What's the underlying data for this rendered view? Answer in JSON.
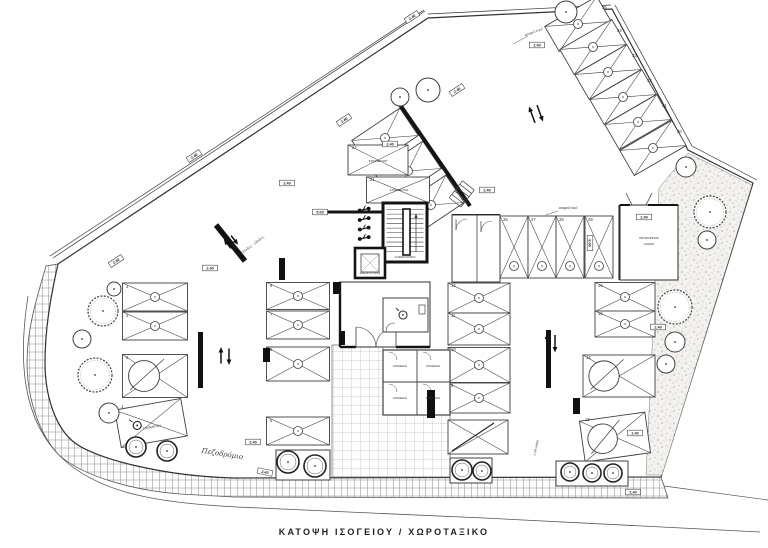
{
  "meta": {
    "caption": "ΚΑΤΟΨΗ ΙΣΟΓΕΙΟΥ / ΧΩΡΟΤΑΞΙΚΟ"
  },
  "colors": {
    "line": "#3f3f3f",
    "wall": "#141414",
    "text": "#2b2b2b"
  },
  "stalls": [
    {
      "n": "35",
      "x": 578,
      "y": 24,
      "l": 60,
      "w": 29,
      "r": -30,
      "sym": "circle",
      "nd": [
        24,
        -15
      ]
    },
    {
      "n": "34",
      "x": 593,
      "y": 47,
      "l": 60,
      "w": 29,
      "r": -30,
      "sym": "circle",
      "nd": [
        24,
        -15
      ]
    },
    {
      "n": "33",
      "x": 608,
      "y": 72,
      "l": 60,
      "w": 29,
      "r": -30,
      "sym": "circle",
      "nd": [
        24,
        -15
      ]
    },
    {
      "n": "32",
      "x": 623,
      "y": 97,
      "l": 60,
      "w": 29,
      "r": -30,
      "sym": "circle",
      "nd": [
        24,
        -15
      ]
    },
    {
      "n": "31",
      "x": 638,
      "y": 122,
      "l": 60,
      "w": 29,
      "r": -30,
      "sym": "circle",
      "nd": [
        24,
        -15
      ]
    },
    {
      "n": "30",
      "x": 653,
      "y": 148,
      "l": 60,
      "w": 29,
      "r": -30,
      "sym": "circle",
      "nd": [
        24,
        -15
      ]
    },
    {
      "n": "23",
      "x": 385,
      "y": 138,
      "l": 58,
      "w": 33,
      "r": -34,
      "sym": "circle",
      "nd": [
        31,
        -5
      ]
    },
    {
      "n": "24",
      "x": 408,
      "y": 171,
      "l": 58,
      "w": 33,
      "r": -34,
      "sym": "circle",
      "nd": [
        31,
        -5
      ]
    },
    {
      "n": "25",
      "x": 431,
      "y": 205,
      "l": 58,
      "w": 33,
      "r": -34,
      "sym": "circle",
      "nd": [
        31,
        -5
      ]
    },
    {
      "n": "22",
      "x": 378,
      "y": 160,
      "l": 60,
      "w": 30,
      "r": 0,
      "sym": "none",
      "nd": [
        -26,
        -11
      ]
    },
    {
      "n": "21",
      "x": 398,
      "y": 190,
      "l": 63,
      "w": 26,
      "r": 0,
      "sym": "none",
      "nd": [
        -28,
        -9
      ]
    },
    {
      "n": "26",
      "x": 514,
      "y": 247,
      "l": 62,
      "w": 28,
      "r": 90,
      "sym": "circle-out",
      "nd": [
        -11,
        -26
      ]
    },
    {
      "n": "27",
      "x": 542,
      "y": 247,
      "l": 62,
      "w": 28,
      "r": 90,
      "sym": "circle-out",
      "nd": [
        -11,
        -26
      ]
    },
    {
      "n": "28",
      "x": 570,
      "y": 247,
      "l": 62,
      "w": 28,
      "r": 90,
      "sym": "circle-out",
      "nd": [
        -11,
        -26
      ]
    },
    {
      "n": "29",
      "x": 599,
      "y": 247,
      "l": 62,
      "w": 28,
      "r": 90,
      "sym": "circle-out",
      "nd": [
        -11,
        -26
      ]
    },
    {
      "n": "4",
      "x": 155,
      "y": 297,
      "l": 65,
      "w": 28,
      "r": 0,
      "sym": "circle",
      "nd": [
        -29,
        -9
      ]
    },
    {
      "n": "3",
      "x": 155,
      "y": 326,
      "l": 65,
      "w": 28,
      "r": 0,
      "sym": "circle",
      "nd": [
        -29,
        -9
      ]
    },
    {
      "n": "2",
      "x": 155,
      "y": 376,
      "l": 65,
      "w": 43,
      "r": 0,
      "sym": "bigcircle",
      "nd": [
        -29,
        -17
      ]
    },
    {
      "n": "1",
      "x": 151,
      "y": 423,
      "l": 67,
      "w": 38,
      "r": -10,
      "sym": "wheel",
      "nd": [
        -30,
        -15
      ]
    },
    {
      "n": "8",
      "x": 298,
      "y": 296,
      "l": 63,
      "w": 27,
      "r": 0,
      "sym": "circle",
      "nd": [
        -28,
        -9
      ]
    },
    {
      "n": "7",
      "x": 298,
      "y": 325,
      "l": 63,
      "w": 28,
      "r": 0,
      "sym": "circle",
      "nd": [
        -28,
        -9
      ]
    },
    {
      "n": "6",
      "x": 298,
      "y": 364,
      "l": 63,
      "w": 34,
      "r": 0,
      "sym": "circle",
      "nd": [
        -28,
        -13
      ]
    },
    {
      "n": "5",
      "x": 298,
      "y": 431,
      "l": 63,
      "w": 28,
      "r": 0,
      "sym": "circle",
      "nd": [
        -28,
        -9
      ]
    },
    {
      "n": "12",
      "x": 479,
      "y": 298,
      "l": 62,
      "w": 30,
      "r": 0,
      "sym": "circle",
      "nd": [
        -28,
        -11
      ]
    },
    {
      "n": "11",
      "x": 479,
      "y": 329,
      "l": 62,
      "w": 32,
      "r": 0,
      "sym": "circle",
      "nd": [
        -28,
        -12
      ]
    },
    {
      "n": "10",
      "x": 479,
      "y": 365,
      "l": 62,
      "w": 35,
      "r": 0,
      "sym": "circle",
      "nd": [
        -28,
        -14
      ]
    },
    {
      "n": "9",
      "x": 479,
      "y": 398,
      "l": 62,
      "w": 30,
      "r": 0,
      "sym": "circle",
      "nd": [
        -28,
        -11
      ]
    },
    {
      "n": "",
      "x": 478,
      "y": 437,
      "l": 60,
      "w": 34,
      "r": 0,
      "sym": "slash",
      "nd": [
        0,
        0
      ]
    },
    {
      "n": "16",
      "x": 625,
      "y": 297,
      "l": 60,
      "w": 29,
      "r": 0,
      "sym": "circle",
      "nd": [
        -27,
        -10
      ]
    },
    {
      "n": "15",
      "x": 625,
      "y": 324,
      "l": 60,
      "w": 26,
      "r": 0,
      "sym": "circle",
      "nd": [
        -27,
        -9
      ]
    },
    {
      "n": "14",
      "x": 619,
      "y": 376,
      "l": 72,
      "w": 42,
      "r": 0,
      "sym": "bigcircle",
      "nd": [
        -33,
        -17
      ]
    },
    {
      "n": "13",
      "x": 615,
      "y": 437,
      "l": 66,
      "w": 41,
      "r": -8,
      "sym": "bigcircle",
      "nd": [
        -30,
        -16
      ]
    }
  ],
  "trees": [
    {
      "x": 103,
      "y": 311,
      "rr": 15,
      "t": "bushy"
    },
    {
      "x": 82,
      "y": 339,
      "rr": 9,
      "t": "plain"
    },
    {
      "x": 95,
      "y": 375,
      "rr": 17,
      "t": "bushy"
    },
    {
      "x": 109,
      "y": 413,
      "rr": 10,
      "t": "plain"
    },
    {
      "x": 114,
      "y": 289,
      "rr": 7,
      "t": "plain"
    },
    {
      "x": 136,
      "y": 447,
      "rr": 10,
      "t": "grate"
    },
    {
      "x": 167,
      "y": 451,
      "rr": 10,
      "t": "grate"
    },
    {
      "x": 288,
      "y": 462,
      "rr": 11,
      "t": "grate"
    },
    {
      "x": 315,
      "y": 466,
      "rr": 11,
      "t": "grate"
    },
    {
      "x": 400,
      "y": 97,
      "rr": 9,
      "t": "plain"
    },
    {
      "x": 428,
      "y": 90,
      "rr": 12,
      "t": "plain"
    },
    {
      "x": 566,
      "y": 12,
      "rr": 11,
      "t": "plain"
    },
    {
      "x": 686,
      "y": 167,
      "rr": 10,
      "t": "plain"
    },
    {
      "x": 710,
      "y": 212,
      "rr": 16,
      "t": "bushy"
    },
    {
      "x": 707,
      "y": 240,
      "rr": 9,
      "t": "plain"
    },
    {
      "x": 675,
      "y": 307,
      "rr": 17,
      "t": "bushy"
    },
    {
      "x": 675,
      "y": 342,
      "rr": 10,
      "t": "plain"
    },
    {
      "x": 666,
      "y": 364,
      "rr": 9,
      "t": "plain"
    },
    {
      "x": 462,
      "y": 470,
      "rr": 10,
      "t": "grate"
    },
    {
      "x": 482,
      "y": 471,
      "rr": 9,
      "t": "grate"
    },
    {
      "x": 570,
      "y": 472,
      "rr": 9,
      "t": "grate"
    },
    {
      "x": 592,
      "y": 473,
      "rr": 9,
      "t": "grate"
    },
    {
      "x": 613,
      "y": 473,
      "rr": 9,
      "t": "grate"
    }
  ],
  "planter_boxes": [
    {
      "x": 450,
      "y": 458,
      "w": 42,
      "h": 25
    },
    {
      "x": 556,
      "y": 461,
      "w": 72,
      "h": 25
    },
    {
      "x": 276,
      "y": 450,
      "w": 54,
      "h": 30
    }
  ],
  "arrows": [
    {
      "x": 536,
      "y": 114,
      "r": -20,
      "len": 16
    },
    {
      "x": 225,
      "y": 356,
      "r": 0,
      "len": 15
    },
    {
      "x": 551,
      "y": 343,
      "r": 0,
      "len": 16
    },
    {
      "x": 231,
      "y": 242,
      "r": -38,
      "len": 10
    }
  ],
  "dim_tags": [
    {
      "x": 344,
      "y": 120,
      "r": -33,
      "t": "2.40"
    },
    {
      "x": 116,
      "y": 261,
      "r": -33,
      "t": "2.40"
    },
    {
      "x": 412,
      "y": 17,
      "r": -33,
      "t": "2.40"
    },
    {
      "x": 194,
      "y": 156,
      "r": -33,
      "t": "2.40"
    },
    {
      "x": 537,
      "y": 45,
      "r": 0,
      "t": "2.40"
    },
    {
      "x": 287,
      "y": 183,
      "r": 0,
      "t": "2.40"
    },
    {
      "x": 390,
      "y": 144,
      "r": 0,
      "t": "2.40"
    },
    {
      "x": 487,
      "y": 190,
      "r": 0,
      "t": "2.40"
    },
    {
      "x": 644,
      "y": 217,
      "r": 0,
      "t": "2.40"
    },
    {
      "x": 590,
      "y": 243,
      "r": 90,
      "t": "6.00"
    },
    {
      "x": 658,
      "y": 327,
      "r": 0,
      "t": "2.40"
    },
    {
      "x": 635,
      "y": 433,
      "r": 0,
      "t": "2.40"
    },
    {
      "x": 265,
      "y": 472,
      "r": 12,
      "t": "2.40"
    },
    {
      "x": 253,
      "y": 442,
      "r": 0,
      "t": "2.40"
    },
    {
      "x": 457,
      "y": 90,
      "r": -33,
      "t": "2.40"
    },
    {
      "x": 320,
      "y": 212,
      "r": 0,
      "t": "5.00"
    },
    {
      "x": 210,
      "y": 268,
      "r": 0,
      "t": "2.40"
    },
    {
      "x": 633,
      "y": 492,
      "r": 0,
      "t": "2.40"
    }
  ],
  "notes": [
    {
      "x": 378,
      "y": 162,
      "r": 0,
      "s": 3.1,
      "st": "room",
      "t": "ΣΤΑΘΜΕΥΣΗ"
    },
    {
      "x": 399,
      "y": 191,
      "r": 0,
      "s": 3.0,
      "st": "room",
      "t": "ΣΤΑΘΜΕΥΣΗ"
    },
    {
      "x": 152,
      "y": 428,
      "r": -10,
      "s": 3.0,
      "st": "room",
      "t": "ΣΤΑΘΜΕΥΣΗ"
    },
    {
      "x": 400,
      "y": 367,
      "r": 0,
      "s": 2.8,
      "st": "room",
      "t": "ΑΠΟΘΗΚΗ"
    },
    {
      "x": 433,
      "y": 367,
      "r": 0,
      "s": 2.8,
      "st": "room",
      "t": "ΑΠΟΘΗΚΗ"
    },
    {
      "x": 400,
      "y": 399,
      "r": 0,
      "s": 2.8,
      "st": "room",
      "t": "ΑΠΟΘΗΚΗ"
    },
    {
      "x": 433,
      "y": 399,
      "r": 0,
      "s": 2.8,
      "st": "room",
      "t": "ΑΠΟΘΗΚΗ"
    },
    {
      "x": 649,
      "y": 239,
      "r": 0,
      "s": 3.0,
      "st": "room",
      "t": "ΠΡΟΣΩΡΙΝΟΣ"
    },
    {
      "x": 649,
      "y": 245,
      "r": 0,
      "s": 3.0,
      "st": "room",
      "t": "ΚΑΔΟΣ"
    },
    {
      "x": 405,
      "y": 258,
      "r": 0,
      "s": 2.6,
      "st": "room",
      "t": "ΚΛΙΜΑΚΟΣΤΑΣΙΟ"
    },
    {
      "x": 370,
      "y": 274,
      "r": 0,
      "s": 2.6,
      "st": "room",
      "t": "ΑΝΕΛΚΥΣΤΗΡΑΣ"
    },
    {
      "x": 537,
      "y": 448,
      "r": -78,
      "s": 3.2,
      "st": "room",
      "t": "± 2% κλίση"
    },
    {
      "x": 253,
      "y": 246,
      "r": -37,
      "s": 3.4,
      "st": "script",
      "t": "είσοδος - έξοδος"
    },
    {
      "x": 568,
      "y": 209,
      "r": 0,
      "s": 3.4,
      "st": "script",
      "t": "ασφαλτικό"
    },
    {
      "x": 534,
      "y": 33,
      "r": -20,
      "s": 3.4,
      "st": "script",
      "t": "ασφαλτικό"
    },
    {
      "x": 222,
      "y": 456,
      "r": 9,
      "s": 7,
      "st": "script",
      "t": "Πεζοδρόμιο"
    }
  ]
}
